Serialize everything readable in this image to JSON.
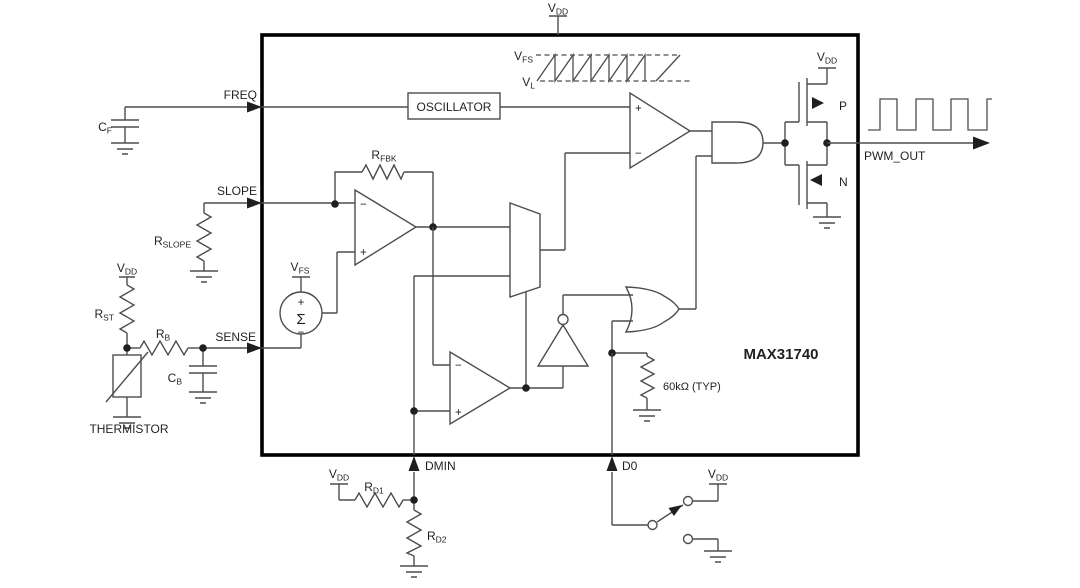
{
  "chip": {
    "name": "MAX31740"
  },
  "blocks": {
    "oscillator": "OSCILLATOR"
  },
  "pins": {
    "freq": "FREQ",
    "slope": "SLOPE",
    "sense": "SENSE",
    "dmin": "DMIN",
    "d0": "D0",
    "pwm_out": "PWM_OUT"
  },
  "components": {
    "cf": {
      "main": "C",
      "sub": "F"
    },
    "rslope": {
      "main": "R",
      "sub": "SLOPE"
    },
    "rst": {
      "main": "R",
      "sub": "ST"
    },
    "rb": {
      "main": "R",
      "sub": "B"
    },
    "cb": {
      "main": "C",
      "sub": "B"
    },
    "rfbk": {
      "main": "R",
      "sub": "FBK"
    },
    "rd1": {
      "main": "R",
      "sub": "D1"
    },
    "rd2": {
      "main": "R",
      "sub": "D2"
    },
    "thermistor": "THERMISTOR",
    "pullup_60k": "60kΩ (TYP)",
    "mosfet_p": "P",
    "mosfet_n": "N"
  },
  "supplies": {
    "vdd": {
      "main": "V",
      "sub": "DD"
    },
    "vfs": {
      "main": "V",
      "sub": "FS"
    },
    "vl": {
      "main": "V",
      "sub": "L"
    }
  },
  "symbols": {
    "plus": "+",
    "minus": "−",
    "sigma": "Σ"
  },
  "colors": {
    "wire": "#4d4d4f",
    "ic_border": "#000000",
    "text": "#231f20",
    "background": "#ffffff"
  }
}
